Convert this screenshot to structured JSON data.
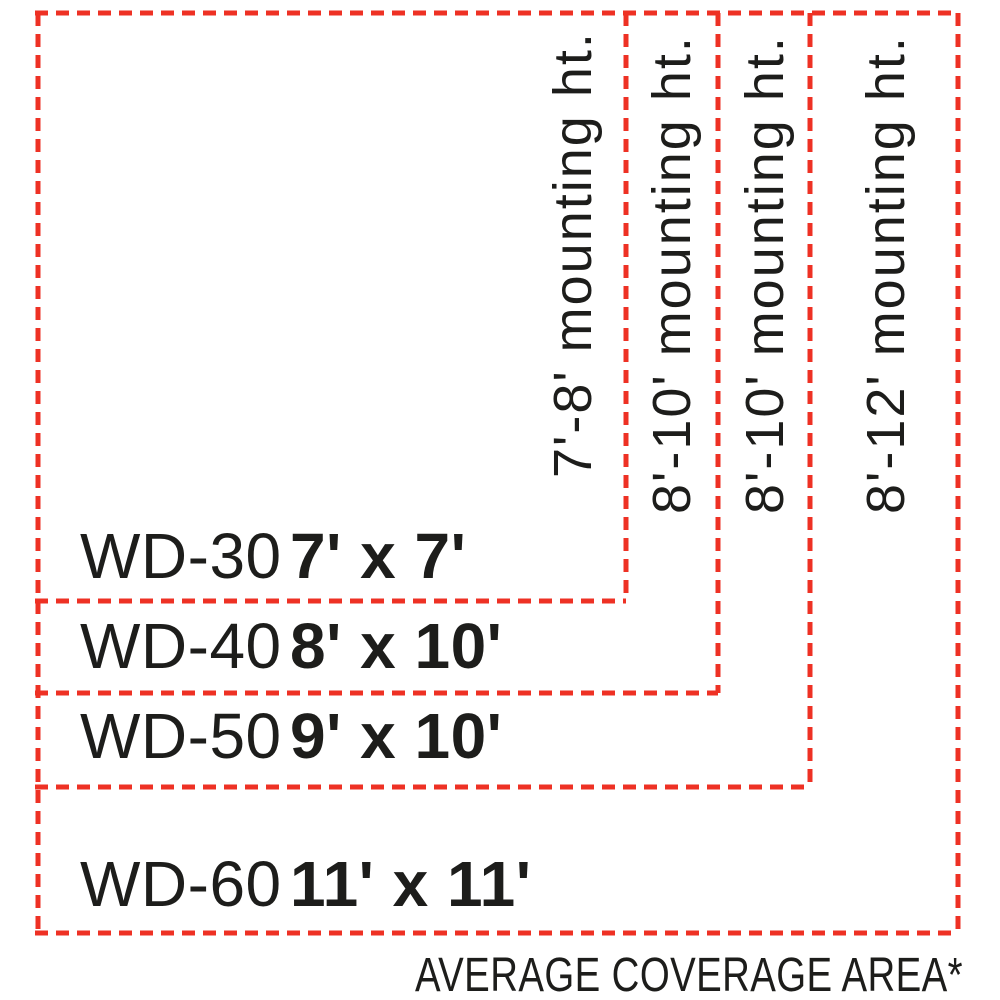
{
  "colors": {
    "dash": "#EE3124",
    "text": "#1D1D1B"
  },
  "products": [
    {
      "model": "WD-30",
      "coverage": "7' x 7'",
      "mounting_height": "7'-8' mounting ht."
    },
    {
      "model": "WD-40",
      "coverage": "8' x 10'",
      "mounting_height": "8'-10' mounting ht."
    },
    {
      "model": "WD-50",
      "coverage": "9' x 10'",
      "mounting_height": "8'-10' mounting ht."
    },
    {
      "model": "WD-60",
      "coverage": "11' x 11'",
      "mounting_height": "8'-12' mounting ht."
    }
  ],
  "footnote": "AVERAGE COVERAGE AREA*"
}
